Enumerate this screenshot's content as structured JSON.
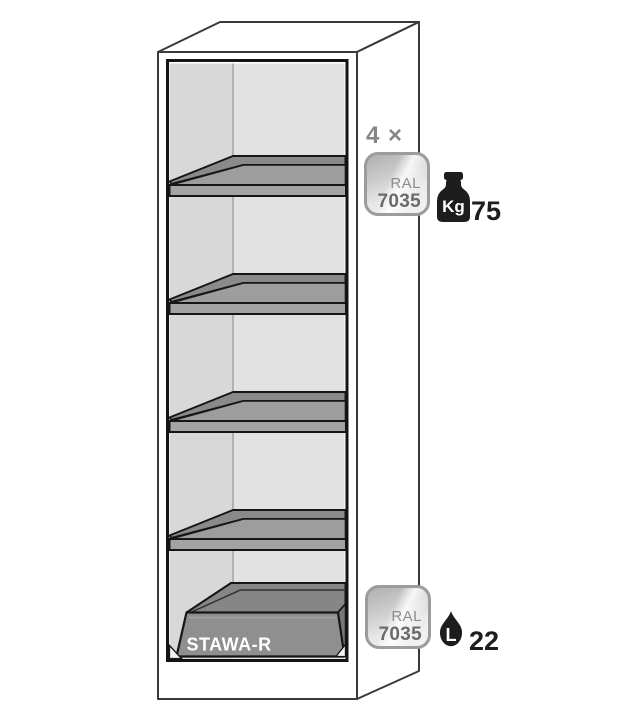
{
  "diagram": {
    "tray_label": "STAWA-R",
    "shelf_count": "4"
  },
  "annotations": {
    "shelves": {
      "quantity_label": "4 ×",
      "badge_line1": "RAL",
      "badge_line2": "7035",
      "weight_unit": "Kg",
      "weight_value": "75"
    },
    "sump": {
      "badge_line1": "RAL",
      "badge_line2": "7035",
      "volume_unit": "L",
      "volume_value": "22"
    }
  },
  "colors": {
    "badge_border": "#9c9c9c",
    "badge_code_text": "#6b6b6b",
    "badge_ral_text": "#8d8d8d",
    "quantity_text": "#868686",
    "icon_black": "#1d1d1d",
    "value_text": "#1d1d1d",
    "shelf_top_gray": "#9d9d9d",
    "shelf_edge_gray": "#8a8a8a",
    "shelf_strip_gray": "#a3a3a3",
    "tray_gray": "#8f8f8f",
    "interior_left_wall": "#d8d8d8",
    "interior_back_wall": "#e2e2e2",
    "opening_outline": "#141414",
    "cabinet_outline": "#3a3a3a"
  }
}
